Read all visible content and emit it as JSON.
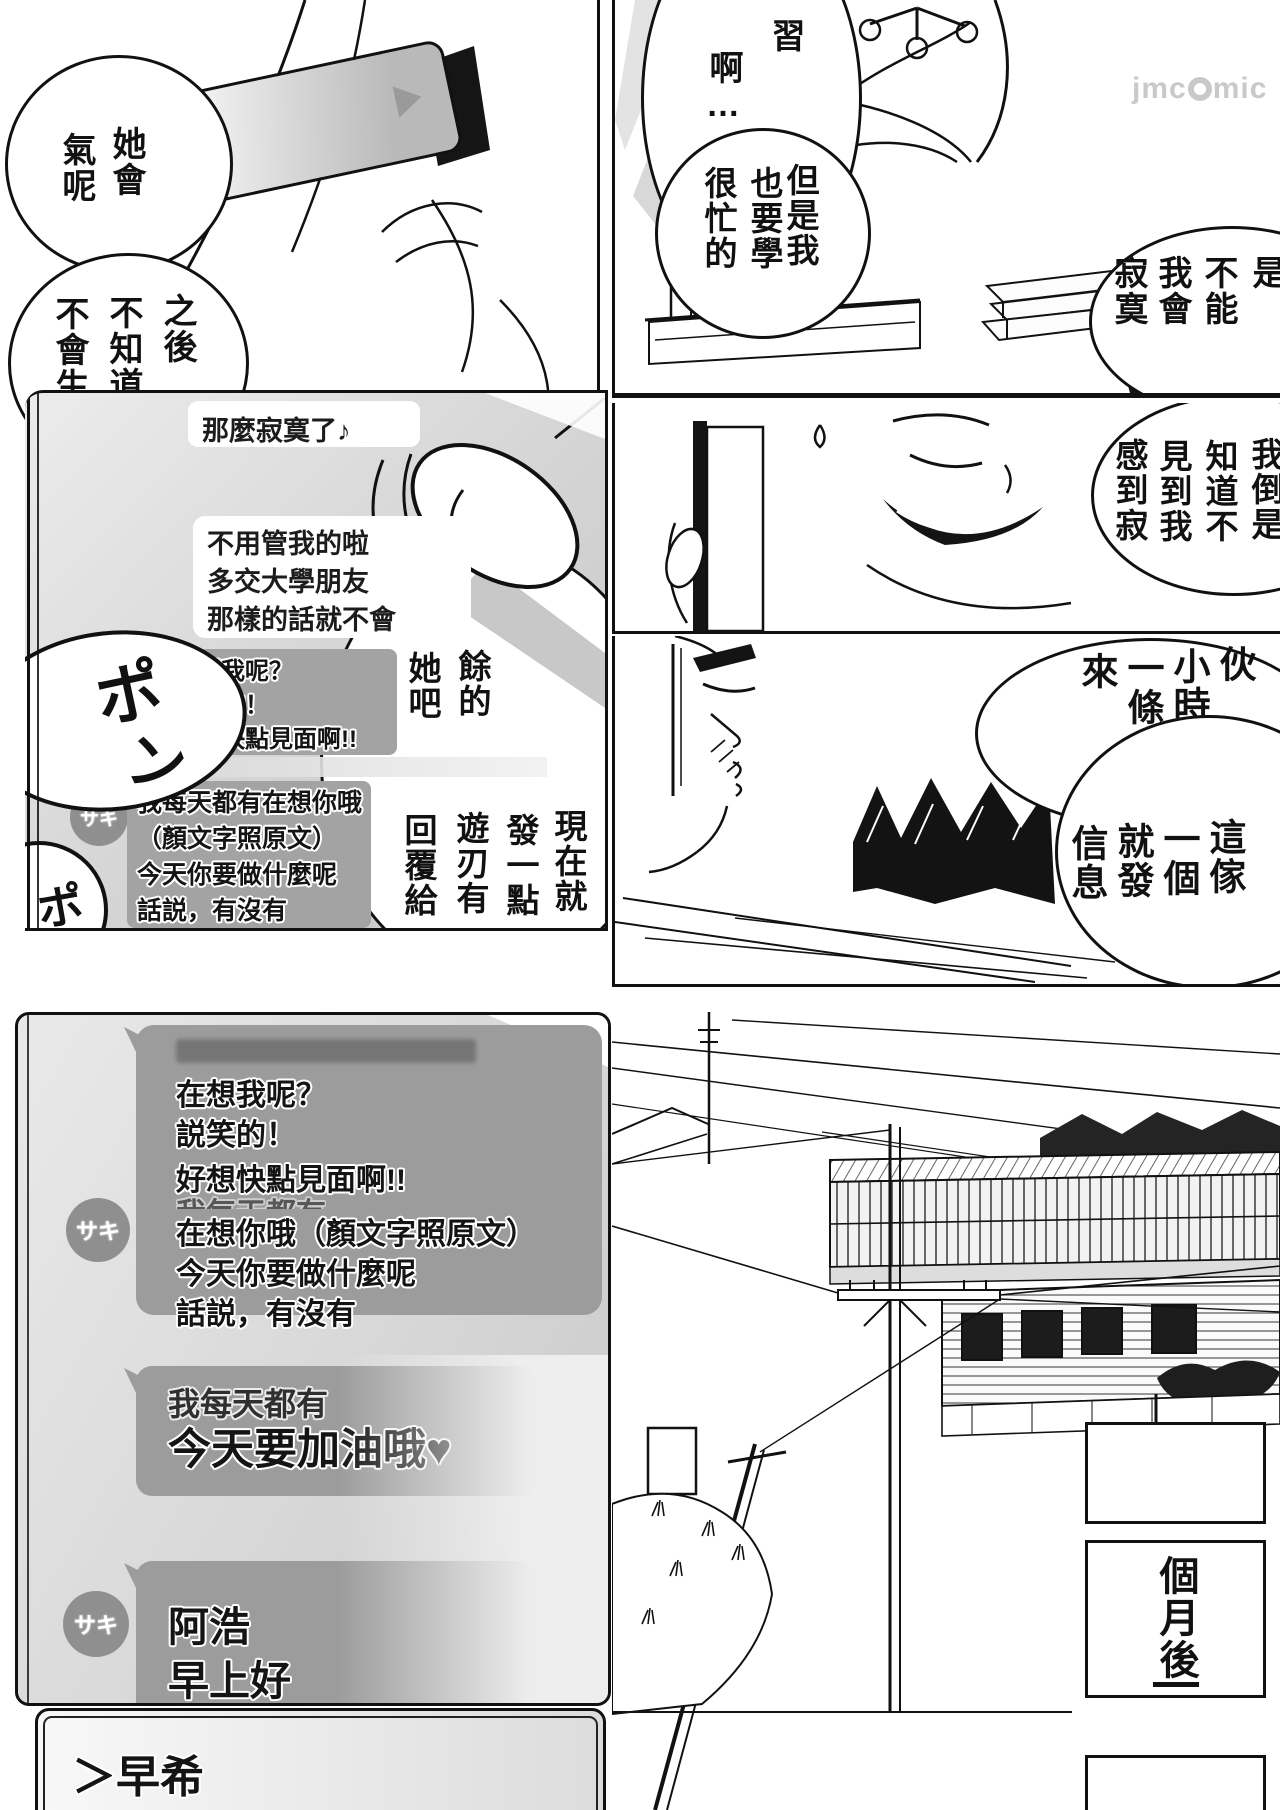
{
  "watermark": {
    "pre": "jmc",
    "post": "mic"
  },
  "top_left_panel": {
    "bubble1_cols": [
      "氣呢",
      "她會"
    ],
    "bubble2_cols": [
      "不會生",
      "不知道",
      "之後"
    ]
  },
  "tl_chat": {
    "msg1": "那麼寂寞了♪",
    "msg2": [
      "不用管我的啦",
      "多交大學朋友",
      "那樣的話就不會"
    ],
    "sfx_pon": [
      "ポ",
      "ン"
    ],
    "sfx_partial": "ポ",
    "gray1": [
      "在想我呢？",
      "説笑的！",
      "好想快點見面啊!!"
    ],
    "avatar": "サキ",
    "gray2": [
      "我每天都有在想你哦",
      "（顏文字照原文）",
      "今天你要做什麼呢",
      "話説，有沒有"
    ],
    "vb_upper": [
      "她吧",
      "餘的"
    ],
    "vb_lower": [
      "回覆給",
      "遊刃有",
      "發一點",
      "現在就"
    ]
  },
  "top_right": {
    "bubbleA_cols": [
      "啊…",
      "習"
    ],
    "bubbleB_cols": [
      "很忙的",
      "也要學",
      "但是我"
    ],
    "bubbleC_cols": [
      "寂寞",
      "我會",
      "不能",
      "是"
    ],
    "bubbleD_cols": [
      "感到寂",
      "見到我",
      "知道不",
      "我倒是"
    ],
    "bubbleE_upper_cols": [
      "來",
      "一條",
      "小時",
      "伙"
    ],
    "bubbleE_lower_cols": [
      "信息",
      "就發",
      "一個",
      "這傢"
    ]
  },
  "bottom_left": {
    "big_bubble_lines": [
      "在想我呢？",
      "説笑的！",
      "好想快點見面啊!!",
      "我每天都有",
      "在想你哦（顏文字照原文）",
      "今天你要做什麼呢",
      "話説，有沒有"
    ],
    "avatar": "サキ",
    "bubble2_lines": [
      "我每天都有",
      "今天要加油哦♥"
    ],
    "bubble3_lines": [
      "阿浩",
      "早上好"
    ],
    "reply_text": "＞早希"
  },
  "bottom_right": {
    "caption": "個月後"
  },
  "colors": {
    "ink": "#111111",
    "bubble_gray": "#9c9c9c",
    "avatar_gray": "#8f8f8f",
    "chat_bg_light": "#ececec",
    "chat_bg_dark": "#c9c9c9",
    "watermark_gray": "#c9c9c9"
  }
}
